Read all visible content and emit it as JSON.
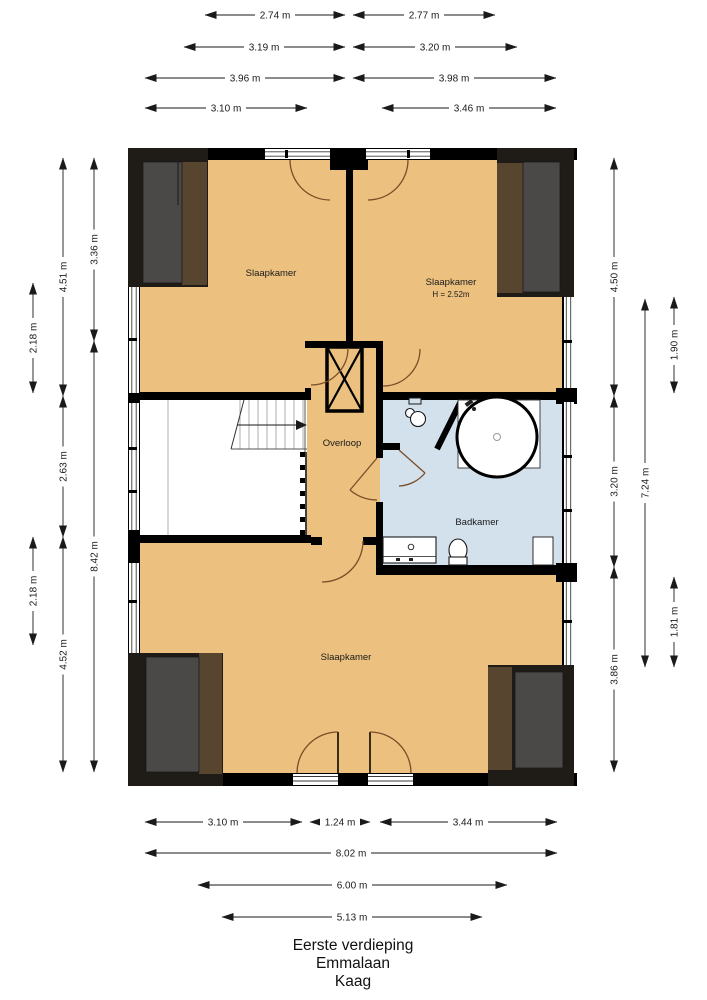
{
  "title_lines": [
    "Eerste verdieping",
    "Emmalaan",
    "Kaag"
  ],
  "rooms": {
    "bedroom_top_left": "Slaapkamer",
    "bedroom_top_right": "Slaapkamer",
    "bedroom_top_right_height": "H = 2.52m",
    "landing": "Overloop",
    "bathroom": "Badkamer",
    "bedroom_bottom": "Slaapkamer"
  },
  "dimensions": {
    "top": [
      "2.74 m",
      "2.77 m",
      "3.19 m",
      "3.20 m",
      "3.96 m",
      "3.98 m",
      "3.10 m",
      "3.46 m"
    ],
    "left": [
      "3.36 m",
      "8.42 m",
      "4.51 m",
      "2.63 m",
      "4.52 m",
      "2.18 m",
      "2.18 m"
    ],
    "right": [
      "4.50 m",
      "3.20 m",
      "3.86 m",
      "7.24 m",
      "1.90 m",
      "1.81 m"
    ],
    "bottom": [
      "3.10 m",
      "1.24 m",
      "3.44 m",
      "8.02 m",
      "6.00 m",
      "5.13 m"
    ]
  },
  "colors": {
    "floor": "#ecc180",
    "bathroom_floor": "#d3e1ed",
    "walls": "#000000",
    "dormer_dark": "#1f1c17",
    "dormer_gray": "#4b4947",
    "dormer_brown": "#57452f",
    "door_arc": "#7a4e28"
  }
}
